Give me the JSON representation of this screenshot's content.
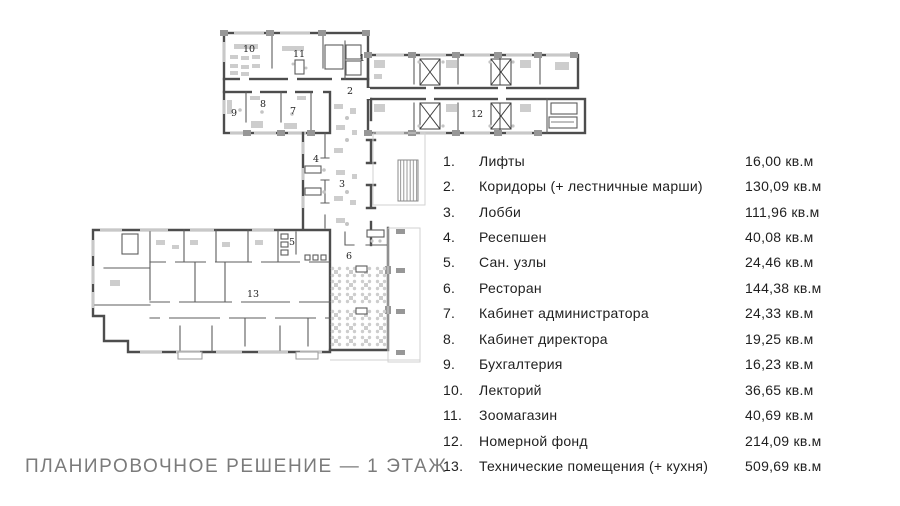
{
  "title": "ПЛАНИРОВОЧНОЕ РЕШЕНИЕ — 1 ЭТАЖ",
  "plan": {
    "type": "floor-plan",
    "room_labels": [
      "1",
      "2",
      "3",
      "4",
      "5",
      "6",
      "7",
      "8",
      "9",
      "10",
      "11",
      "12",
      "13"
    ]
  },
  "legend": {
    "items": [
      {
        "num": "1.",
        "label": "Лифты",
        "area": "16,00 кв.м"
      },
      {
        "num": "2.",
        "label": "Коридоры (+ лестничные марши)",
        "area": "130,09 кв.м"
      },
      {
        "num": "3.",
        "label": "Лобби",
        "area": "111,96 кв.м"
      },
      {
        "num": "4.",
        "label": "Ресепшен",
        "area": "40,08 кв.м"
      },
      {
        "num": "5.",
        "label": "Сан. узлы",
        "area": "24,46 кв.м"
      },
      {
        "num": "6.",
        "label": "Ресторан",
        "area": "144,38 кв.м"
      },
      {
        "num": "7.",
        "label": "Кабинет администратора",
        "area": "24,33 кв.м"
      },
      {
        "num": "8.",
        "label": "Кабинет директора",
        "area": "19,25 кв.м"
      },
      {
        "num": "9.",
        "label": "Бухгалтерия",
        "area": "16,23 кв.м"
      },
      {
        "num": "10.",
        "label": "Лекторий",
        "area": "36,65 кв.м"
      },
      {
        "num": "11.",
        "label": "Зоомагазин",
        "area": "40,69 кв.м"
      },
      {
        "num": "12.",
        "label": "Номерной фонд",
        "area": "214,09 кв.м"
      },
      {
        "num": "13.",
        "label": "Технические помещения (+ кухня)",
        "area": "509,69 кв.м"
      }
    ]
  },
  "colors": {
    "wall": "#4d4d4d",
    "furniture": "#cdcdcd",
    "title_text": "#7b7b7b",
    "body_text": "#1f1f1f"
  }
}
